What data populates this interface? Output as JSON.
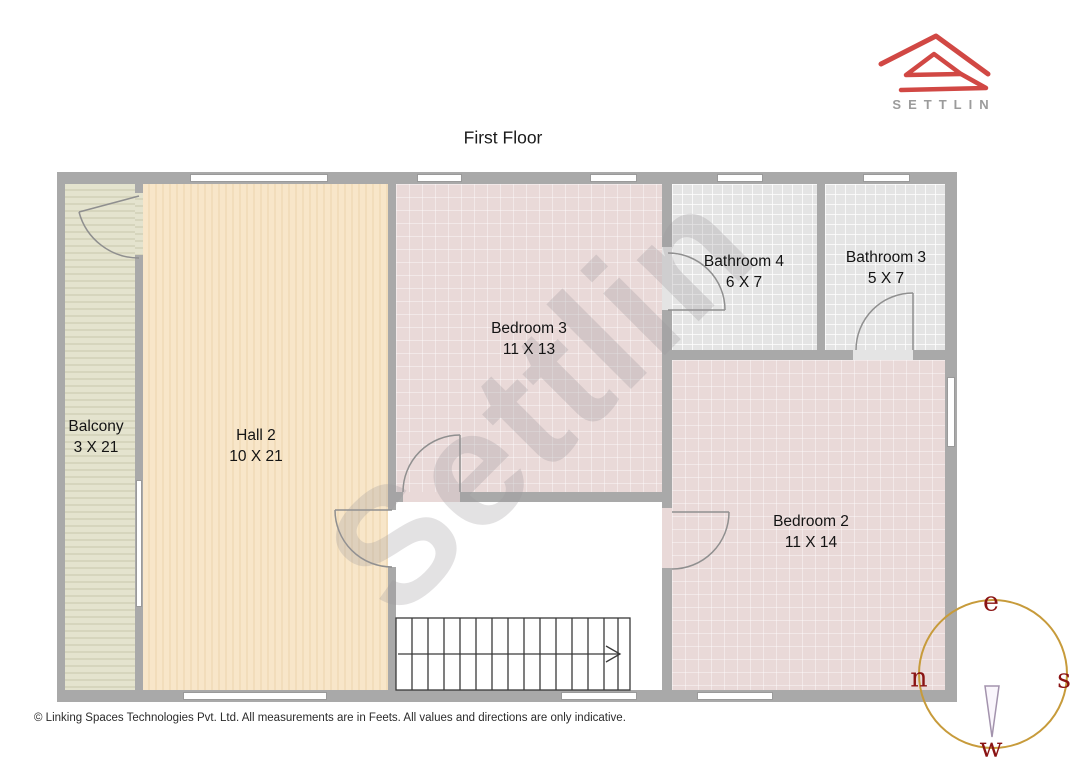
{
  "page": {
    "title": "First Floor",
    "copyright": "© Linking Spaces Technologies Pvt. Ltd. All measurements are in Feets. All values and directions are only indicative."
  },
  "logo": {
    "brand": "SETTLIN"
  },
  "watermark": {
    "text": "Settlin"
  },
  "rooms": {
    "balcony": {
      "name": "Balcony",
      "dims": "3 X 21"
    },
    "hall2": {
      "name": "Hall 2",
      "dims": "10 X 21"
    },
    "bedroom3": {
      "name": "Bedroom 3",
      "dims": "11 X 13"
    },
    "bathroom4": {
      "name": "Bathroom 4",
      "dims": "6 X 7"
    },
    "bathroom3": {
      "name": "Bathroom 3",
      "dims": "5 X 7"
    },
    "bedroom2": {
      "name": "Bedroom 2",
      "dims": "11 X 14"
    }
  },
  "compass": {
    "top": "e",
    "right": "s",
    "bottom": "w",
    "left": "n"
  },
  "colors": {
    "wall": "#a9a9a9",
    "balcony_floor": "#e0dfca",
    "hall_floor": "#f6e2c2",
    "bedroom_floor": "#e9d9d8",
    "bathroom_floor": "#e4e4e4",
    "logo_red": "#d14844",
    "compass_ring": "#c79b3b",
    "compass_letters": "#8a1313"
  }
}
